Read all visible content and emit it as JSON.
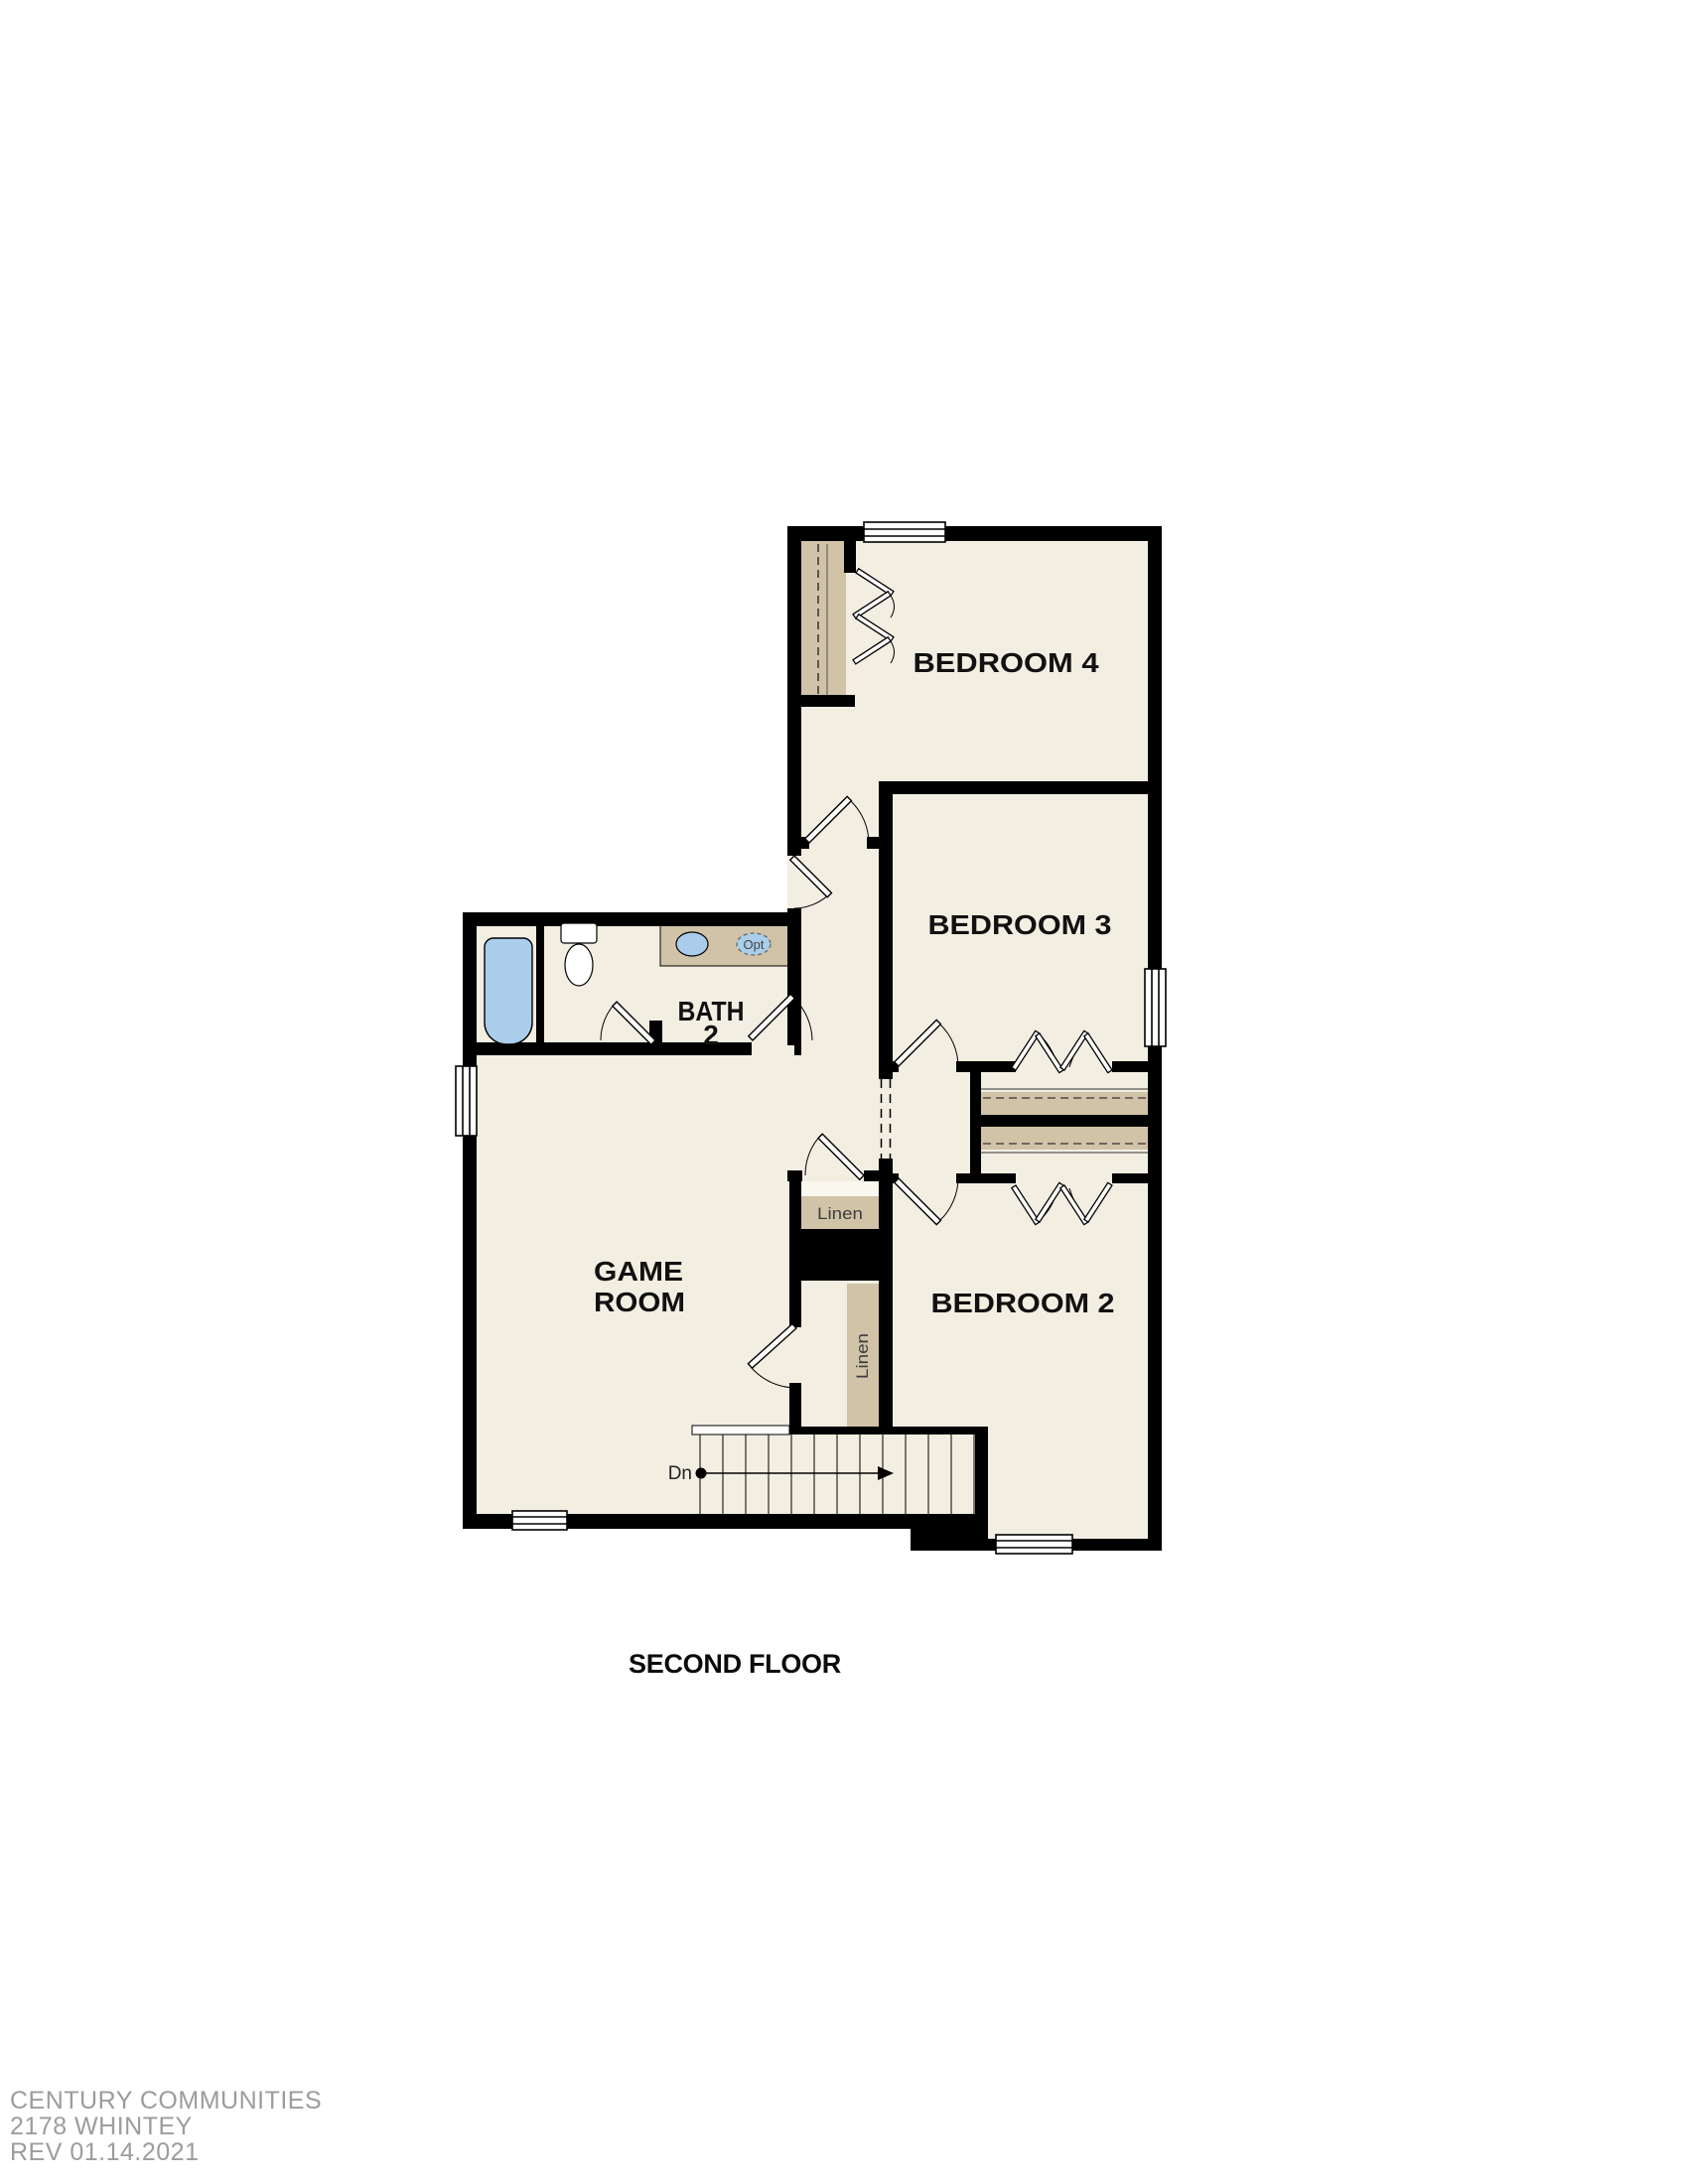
{
  "title": "SECOND FLOOR",
  "rooms": {
    "bedroom4": "BEDROOM 4",
    "bedroom3": "BEDROOM 3",
    "bedroom2": "BEDROOM 2",
    "bath_line1": "BATH",
    "bath_line2": "2",
    "game_line1": "GAME",
    "game_line2": "ROOM"
  },
  "labels": {
    "linen_upper": "Linen",
    "linen_lower": "Linen",
    "stair_direction": "Dn",
    "optional_sink": "Opt"
  },
  "footer": {
    "company": "CENTURY COMMUNITIES",
    "plan": "2178 WHINTEY",
    "revision": "REV 01.14.2021"
  },
  "colors": {
    "floor": "#f3eee2",
    "wall": "#000000",
    "cabinet_tan": "#d1c3a7",
    "fixture_blue": "#a9cdea",
    "footer_gray": "#9c9c9c"
  }
}
